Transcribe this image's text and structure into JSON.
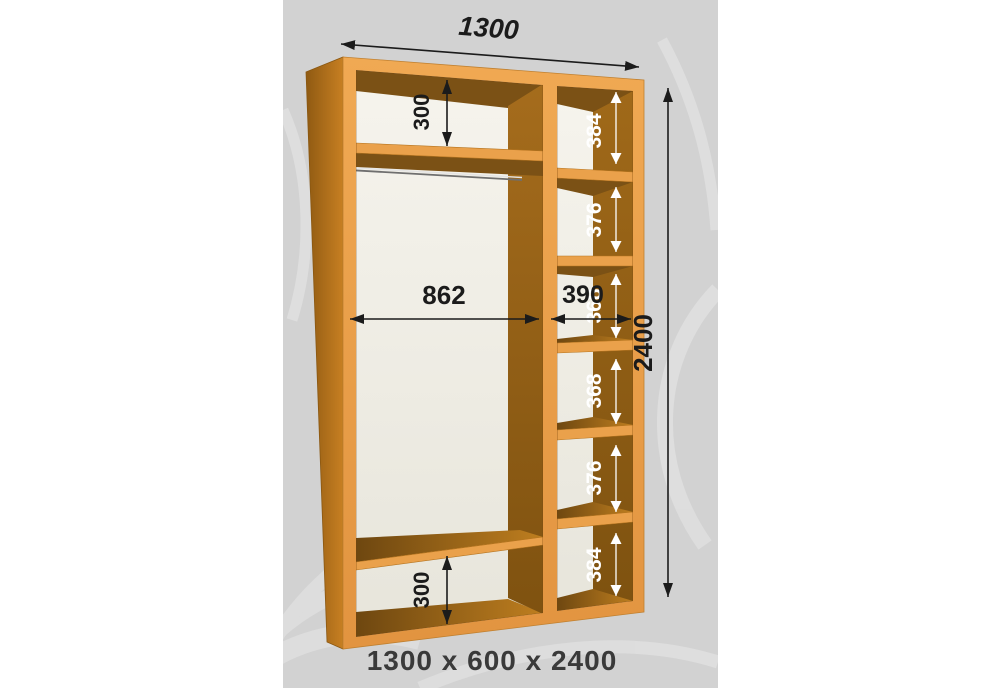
{
  "diagram": {
    "caption": "1300 x 600 x 2400",
    "dimensions": {
      "overall_width": "1300",
      "overall_height": "2400",
      "left_width": "862",
      "right_width": "390",
      "top_gap": "300",
      "bottom_gap": "300"
    },
    "right_shelf_sections": [
      {
        "label": "384"
      },
      {
        "label": "376"
      },
      {
        "label": "368"
      },
      {
        "label": "368"
      },
      {
        "label": "376"
      },
      {
        "label": "384"
      }
    ],
    "colors": {
      "background": "#D2D2D2",
      "swirl": "#DFDFDF",
      "wood_front": "#EAA14B",
      "wood_side": "#B5741B",
      "wood_dark": "#7B5115",
      "interior_back": "#F3F1EA",
      "dimension_text": "#1B1B1B",
      "light_label_text": "#FFFFFF"
    }
  }
}
